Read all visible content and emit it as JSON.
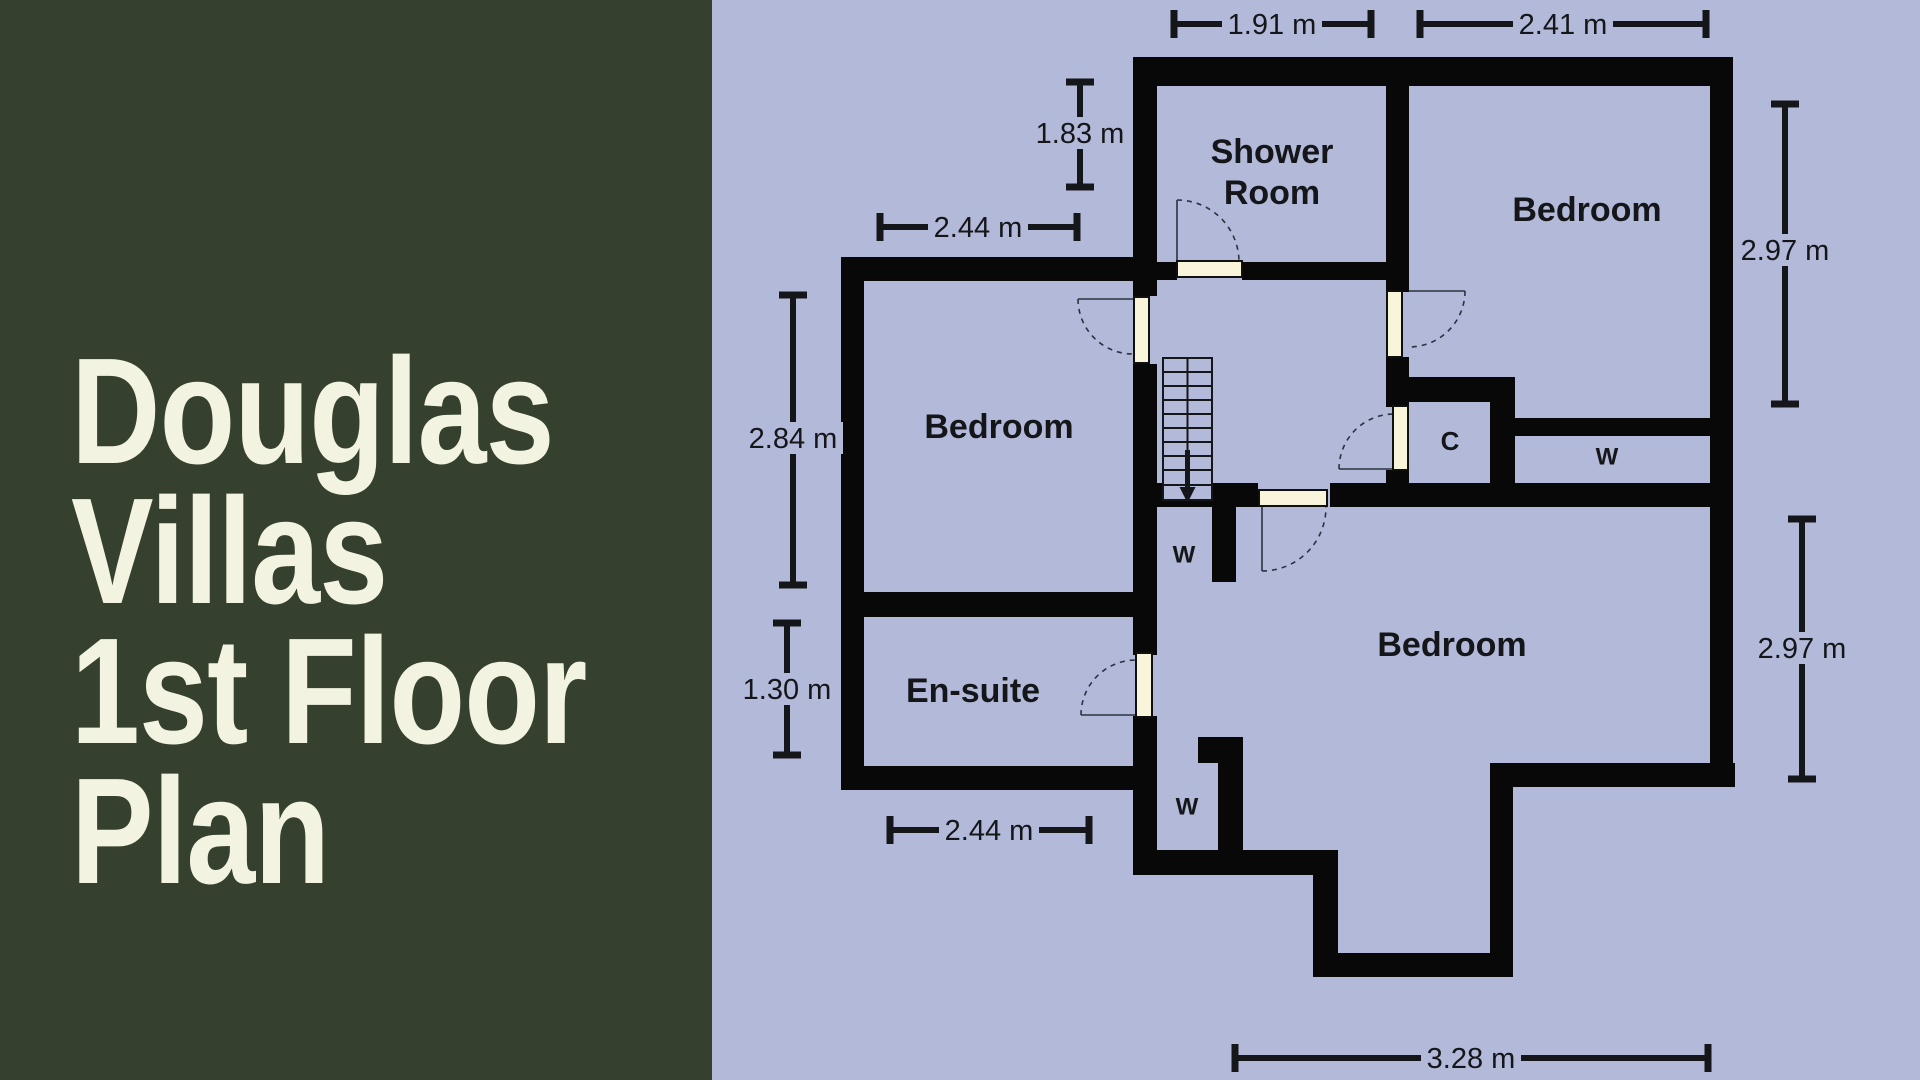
{
  "title": {
    "line1": "Douglas",
    "line2": "Villas",
    "line3": "1st Floor",
    "line4": "Plan"
  },
  "colors": {
    "panel_green": "#36402e",
    "background_lavender": "#b3b9d8",
    "title_cream": "#f2f4e1",
    "wall_black": "#080808",
    "door_cream": "#f8f5da",
    "text_ink": "#14161a"
  },
  "floorplan": {
    "room_labels": [
      {
        "name": "shower-room-label-line1",
        "text": "Shower",
        "x": 1272,
        "y": 152,
        "size": 34,
        "bold": true
      },
      {
        "name": "shower-room-label-line2",
        "text": "Room",
        "x": 1272,
        "y": 193,
        "size": 34,
        "bold": true
      },
      {
        "name": "bedroom-right-label",
        "text": "Bedroom",
        "x": 1587,
        "y": 210,
        "size": 34,
        "bold": true
      },
      {
        "name": "bedroom-left-label",
        "text": "Bedroom",
        "x": 999,
        "y": 427,
        "size": 34,
        "bold": true
      },
      {
        "name": "ensuite-label",
        "text": "En-suite",
        "x": 973,
        "y": 691,
        "size": 34,
        "bold": true
      },
      {
        "name": "bedroom-bottom-label",
        "text": "Bedroom",
        "x": 1452,
        "y": 645,
        "size": 34,
        "bold": true
      },
      {
        "name": "closet-label",
        "text": "C",
        "x": 1450,
        "y": 441,
        "size": 26,
        "bold": true
      },
      {
        "name": "wardrobe-right-label",
        "text": "W",
        "x": 1607,
        "y": 457,
        "size": 24,
        "bold": true
      },
      {
        "name": "wardrobe-upper-label",
        "text": "W",
        "x": 1184,
        "y": 555,
        "size": 24,
        "bold": true
      },
      {
        "name": "wardrobe-lower-label",
        "text": "W",
        "x": 1187,
        "y": 807,
        "size": 24,
        "bold": true
      }
    ],
    "dimensions": [
      {
        "name": "dim-shower-width",
        "label": "1.91 m",
        "dir": "h",
        "x1": 1174,
        "x2": 1371,
        "y": 24,
        "tx": 1272
      },
      {
        "name": "dim-bedroom-right-width",
        "label": "2.41 m",
        "dir": "h",
        "x1": 1420,
        "x2": 1706,
        "y": 24,
        "tx": 1563
      },
      {
        "name": "dim-shower-depth",
        "label": "1.83 m",
        "dir": "v",
        "x": 1080,
        "y1": 82,
        "y2": 187,
        "ty": 133
      },
      {
        "name": "dim-bedroom-left-width",
        "label": "2.44 m",
        "dir": "h",
        "x1": 880,
        "x2": 1077,
        "y": 227,
        "tx": 978
      },
      {
        "name": "dim-bedroom-left-depth",
        "label": "2.84 m",
        "dir": "v",
        "x": 793,
        "y1": 295,
        "y2": 585,
        "ty": 438
      },
      {
        "name": "dim-ensuite-depth",
        "label": "1.30 m",
        "dir": "v",
        "x": 787,
        "y1": 623,
        "y2": 755,
        "ty": 689
      },
      {
        "name": "dim-ensuite-width",
        "label": "2.44 m",
        "dir": "h",
        "x1": 890,
        "x2": 1089,
        "y": 830,
        "tx": 989
      },
      {
        "name": "dim-bedroom-right-depth",
        "label": "2.97 m",
        "dir": "v",
        "x": 1785,
        "y1": 104,
        "y2": 404,
        "ty": 250
      },
      {
        "name": "dim-bedroom-bottom-depth",
        "label": "2.97 m",
        "dir": "v",
        "x": 1802,
        "y1": 519,
        "y2": 779,
        "ty": 648
      },
      {
        "name": "dim-bedroom-bottom-width",
        "label": "3.28 m",
        "dir": "h",
        "x1": 1235,
        "x2": 1708,
        "y": 1058,
        "tx": 1471
      }
    ]
  }
}
